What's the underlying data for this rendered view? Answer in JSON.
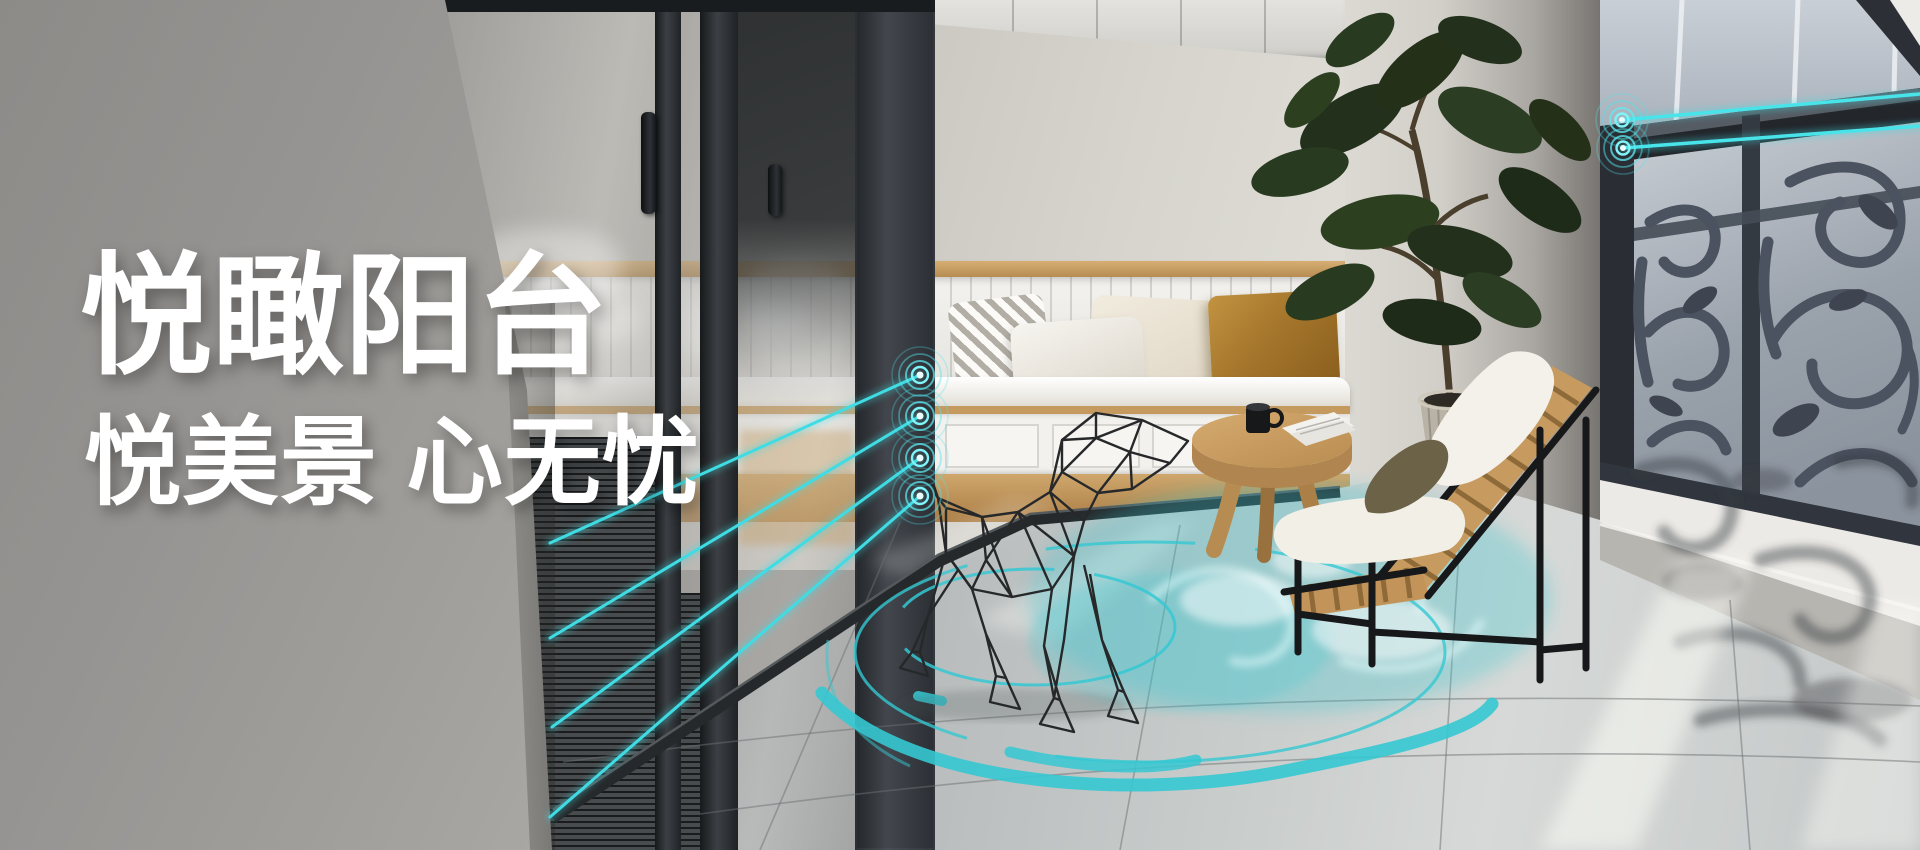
{
  "hero": {
    "title": "悦瞰阳台",
    "subtitle": "悦美景 心无忧"
  },
  "accent_colors": {
    "radar_teal": "#3FDCE4",
    "detection_zone_teal": "#3EC6D0"
  }
}
